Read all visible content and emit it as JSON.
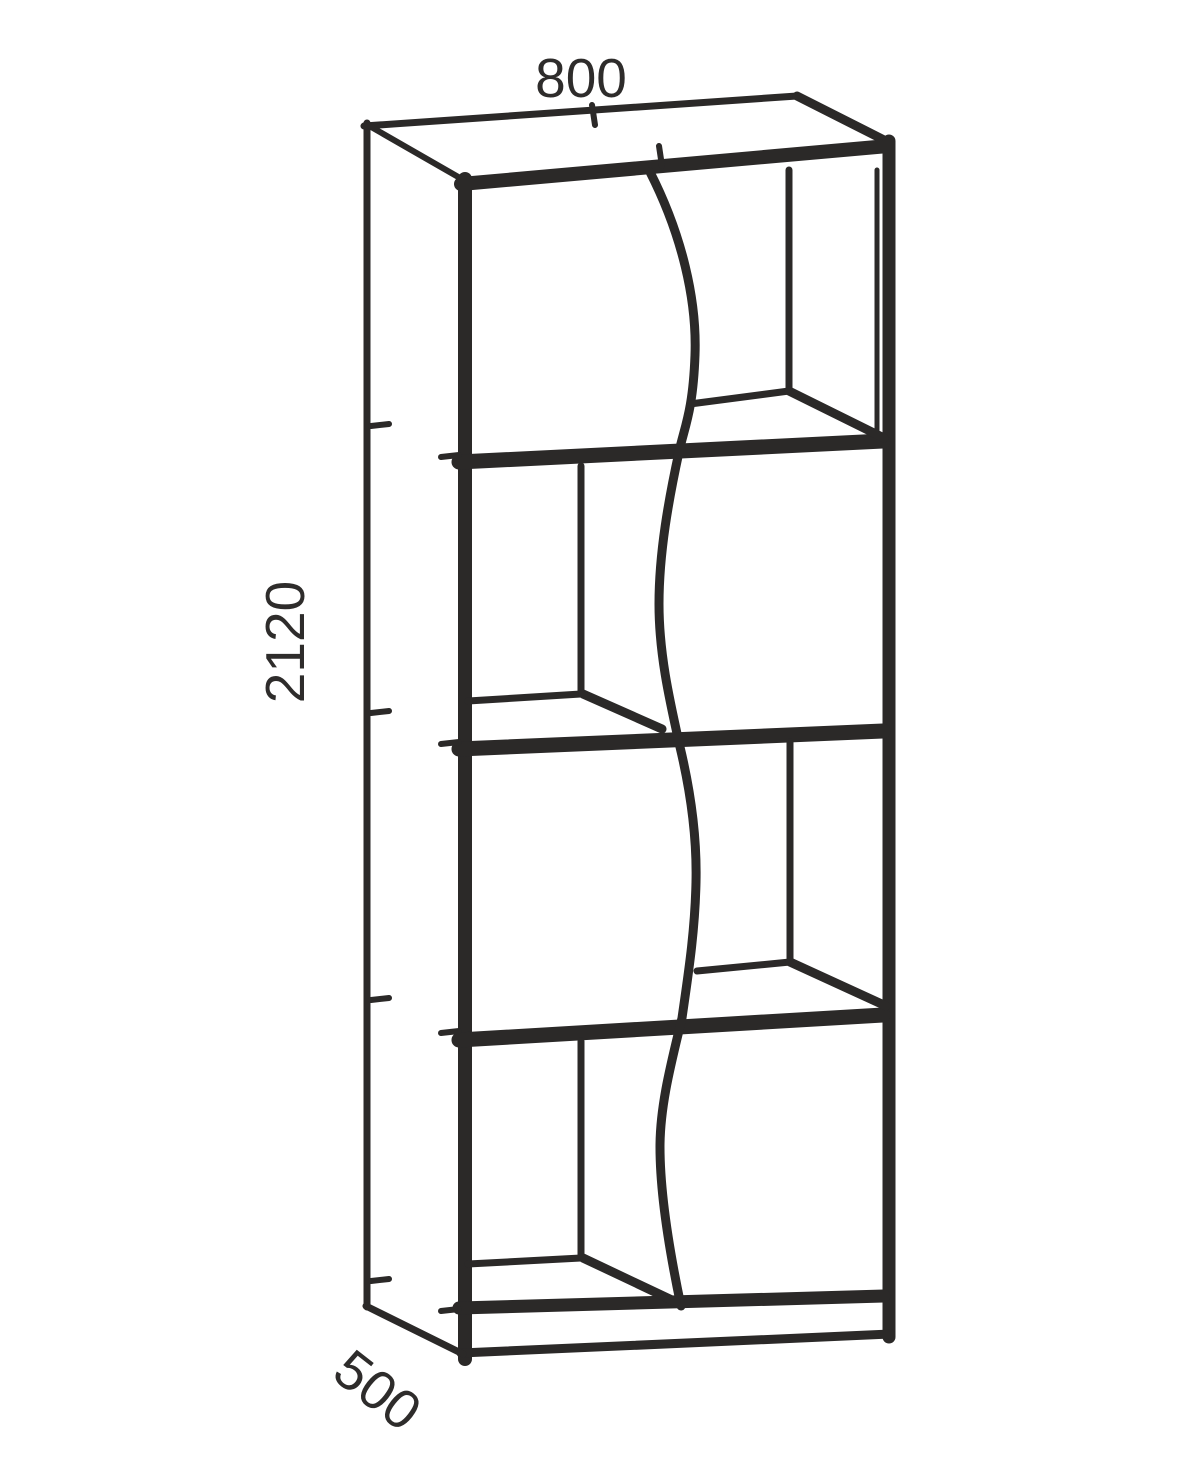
{
  "drawing": {
    "dimensions": {
      "width_label": "800",
      "height_label": "2120",
      "depth_label": "500"
    }
  }
}
